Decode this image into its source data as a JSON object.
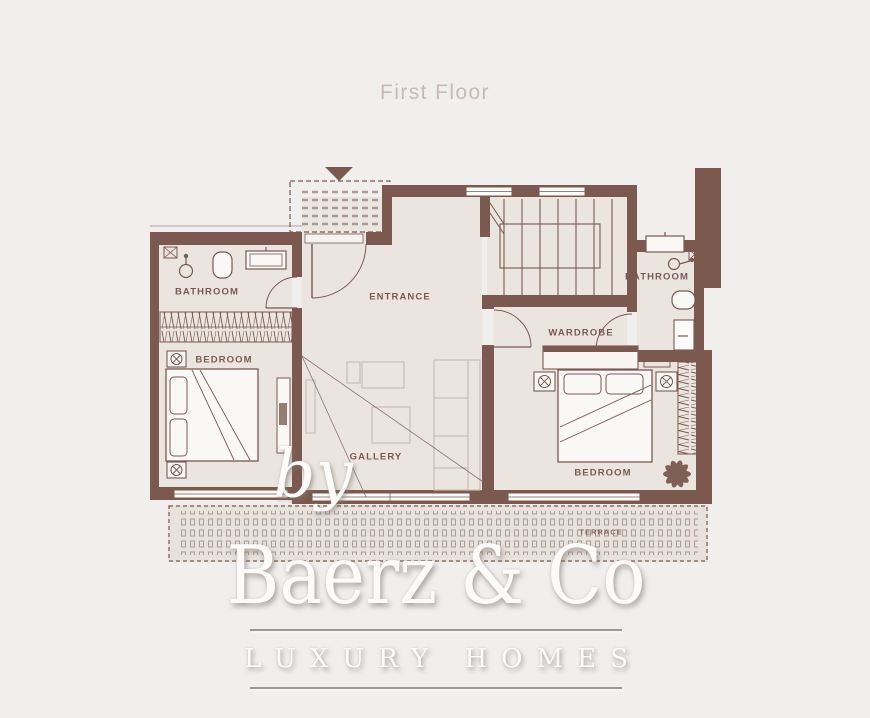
{
  "page": {
    "title": "First Floor"
  },
  "plan": {
    "rooms": {
      "bathroom_left": "BATHROOM",
      "bedroom_left": "BEDROOM",
      "entrance": "ENTRANCE",
      "gallery": "GALLERY",
      "wardrobe": "WARDROBE",
      "bathroom_right": "BATHROOM",
      "bedroom_right": "BEDROOM",
      "terrace": "TERRACE"
    },
    "colors": {
      "wall": "#7b594f",
      "floor": "#ebe5e0",
      "background": "#f0efee",
      "title_text": "#c7bab5",
      "terrace_pattern": "#a8948a",
      "furniture_light": "#c8bdb6",
      "watermark": "#fcfbfa"
    }
  },
  "watermark": {
    "prefix": "by",
    "brand": "Baerz & Co",
    "tagline": "LUXURY HOMES"
  }
}
